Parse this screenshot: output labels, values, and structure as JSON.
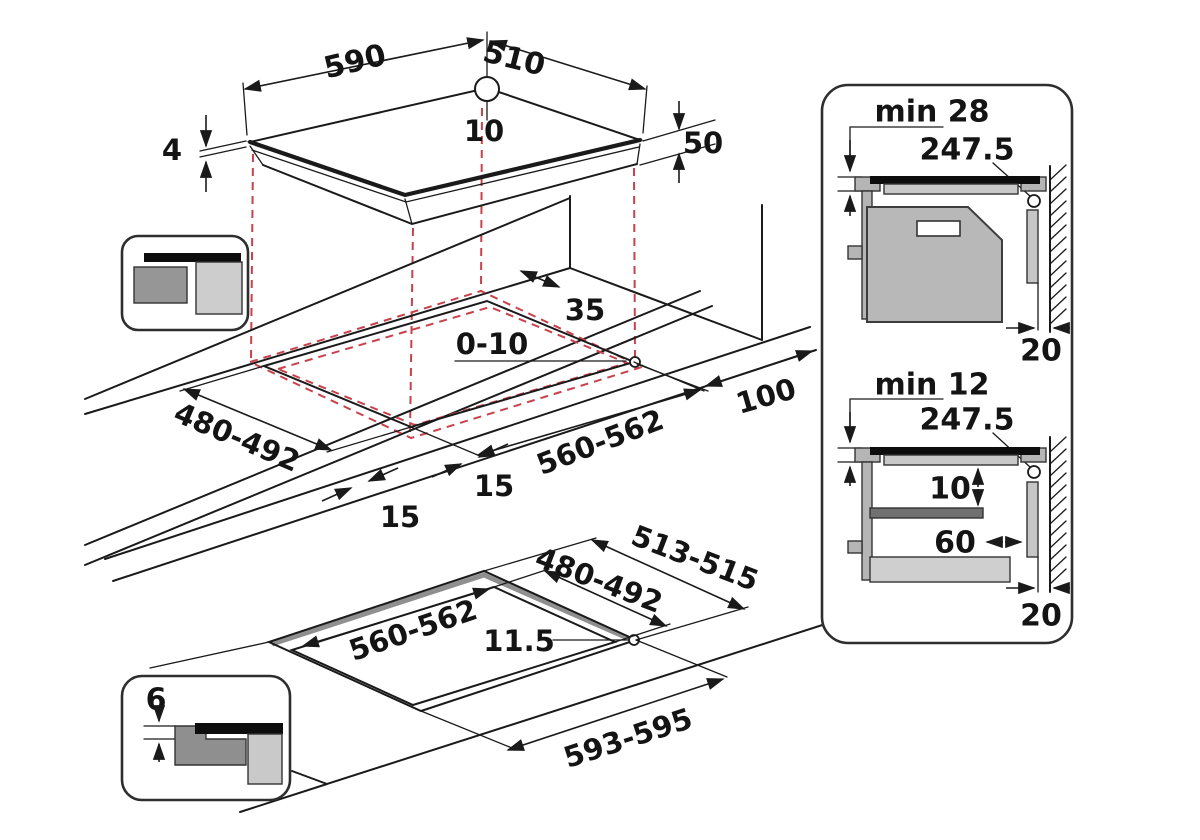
{
  "drawing": {
    "top_view": {
      "width": "590",
      "depth": "510",
      "cable_offset": "10",
      "glass_thickness": "4",
      "body_height": "50"
    },
    "cutout_view": {
      "rear_clearance": "35",
      "edge_gap": "0-10",
      "cutout_depth": "480-492",
      "side_margin_left": "15",
      "side_margin_front": "15",
      "cutout_width": "560-562",
      "wall_distance": "100"
    },
    "flush_view": {
      "outer_depth": "513-515",
      "inner_depth": "480-492",
      "inner_width": "560-562",
      "corner_radius": "11.5",
      "outer_width": "593-595",
      "rebate_depth": "6"
    },
    "side_view_top": {
      "clearance": "min 28",
      "cable_position": "247.5",
      "wall_gap": "20"
    },
    "side_view_bottom": {
      "clearance": "min 12",
      "cable_position": "247.5",
      "shelf_gap": "10",
      "shelf_offset": "60",
      "wall_gap": "20"
    }
  },
  "colors": {
    "line": "#1a1a1a",
    "projection_red": "#c8414b",
    "oven_gray": "#b8b8b8",
    "light_gray": "#cdcdcd",
    "dark_gray": "#8f8f8f",
    "glass_black": "#0d0d0d"
  }
}
